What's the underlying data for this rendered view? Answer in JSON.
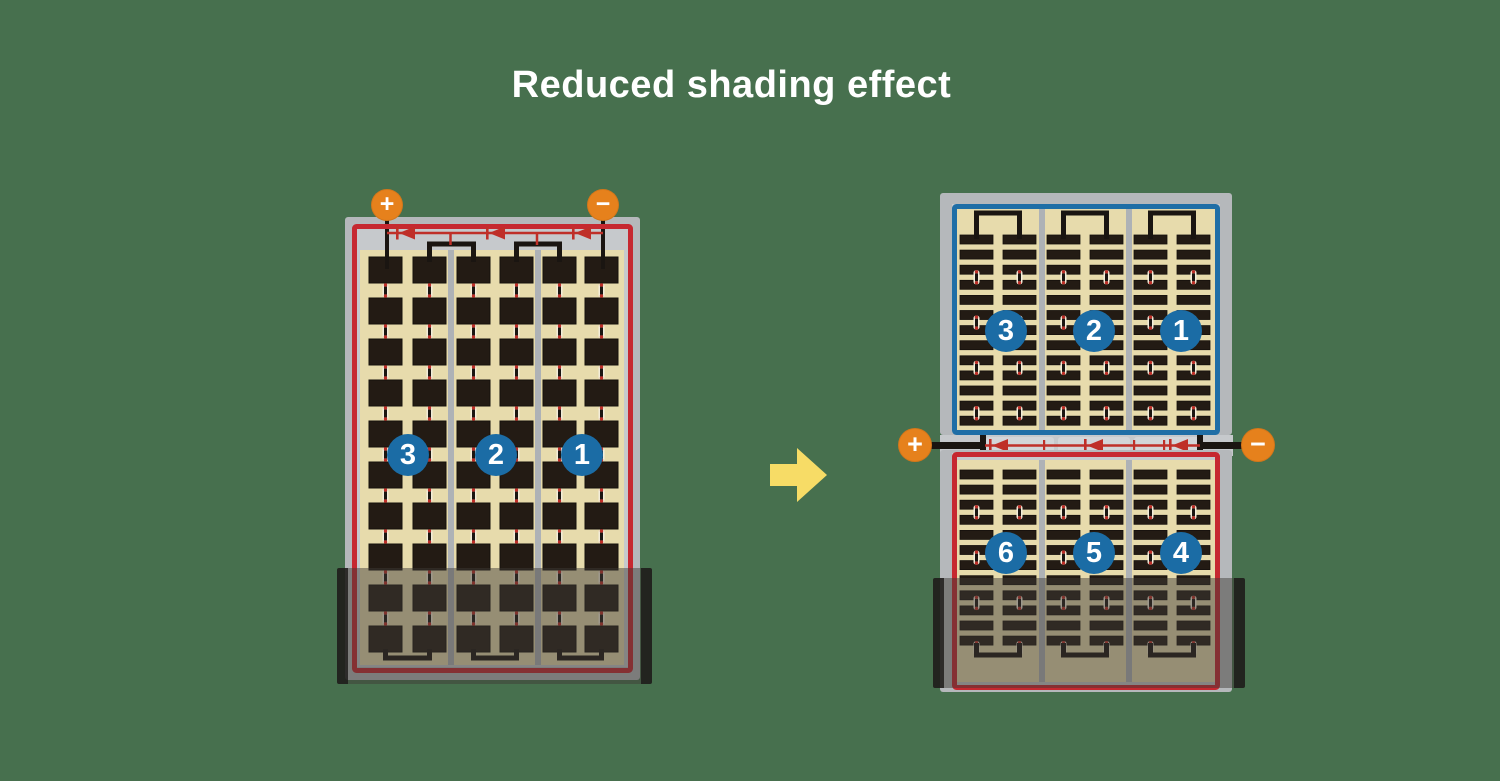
{
  "title": "Reduced shading effect",
  "colors": {
    "background": "#47704e",
    "title_text": "#ffffff",
    "terminal_orange": "#e6811c",
    "circle_blue": "#1b6ca5",
    "border_blue": "#1f6ea6",
    "border_red": "#c62830",
    "circuit_red": "#bf2f28",
    "frame_gray": "#b5b8bb",
    "corridor_gray": "#c6c9cc",
    "pill_gray": "#d2d5d8",
    "divider_gray": "#aeb2b6",
    "panel_tan": "#e7dbac",
    "cell_dark": "#231b14",
    "wire_black": "#1a1511",
    "rivet_light": "#f3edda",
    "arrow_yellow": "#f7dc66",
    "shade_overlay": "rgba(62,58,54,0.48)",
    "shade_edge": "rgba(28,26,25,0.82)"
  },
  "left_panel": {
    "description": "full-size-cell panel, one shading-affected zone",
    "terminals": {
      "positive": "+",
      "negative": "−"
    },
    "strings": [
      "3",
      "2",
      "1"
    ],
    "sections": 3,
    "cell_columns": 6,
    "cell_rows": 10,
    "shaded_rows": 2,
    "bypass_diodes": 3
  },
  "right_panel": {
    "description": "half-cut-cell split panel, shading affects only bottom half",
    "terminals": {
      "positive": "+",
      "negative": "−"
    },
    "top_half_strings": [
      "3",
      "2",
      "1"
    ],
    "bottom_half_strings": [
      "6",
      "5",
      "4"
    ],
    "sections_per_half": 3,
    "strip_rows_top": 13,
    "strip_rows_bottom": 12,
    "bypass_diodes": 3
  },
  "arrow": {
    "direction": "right"
  }
}
